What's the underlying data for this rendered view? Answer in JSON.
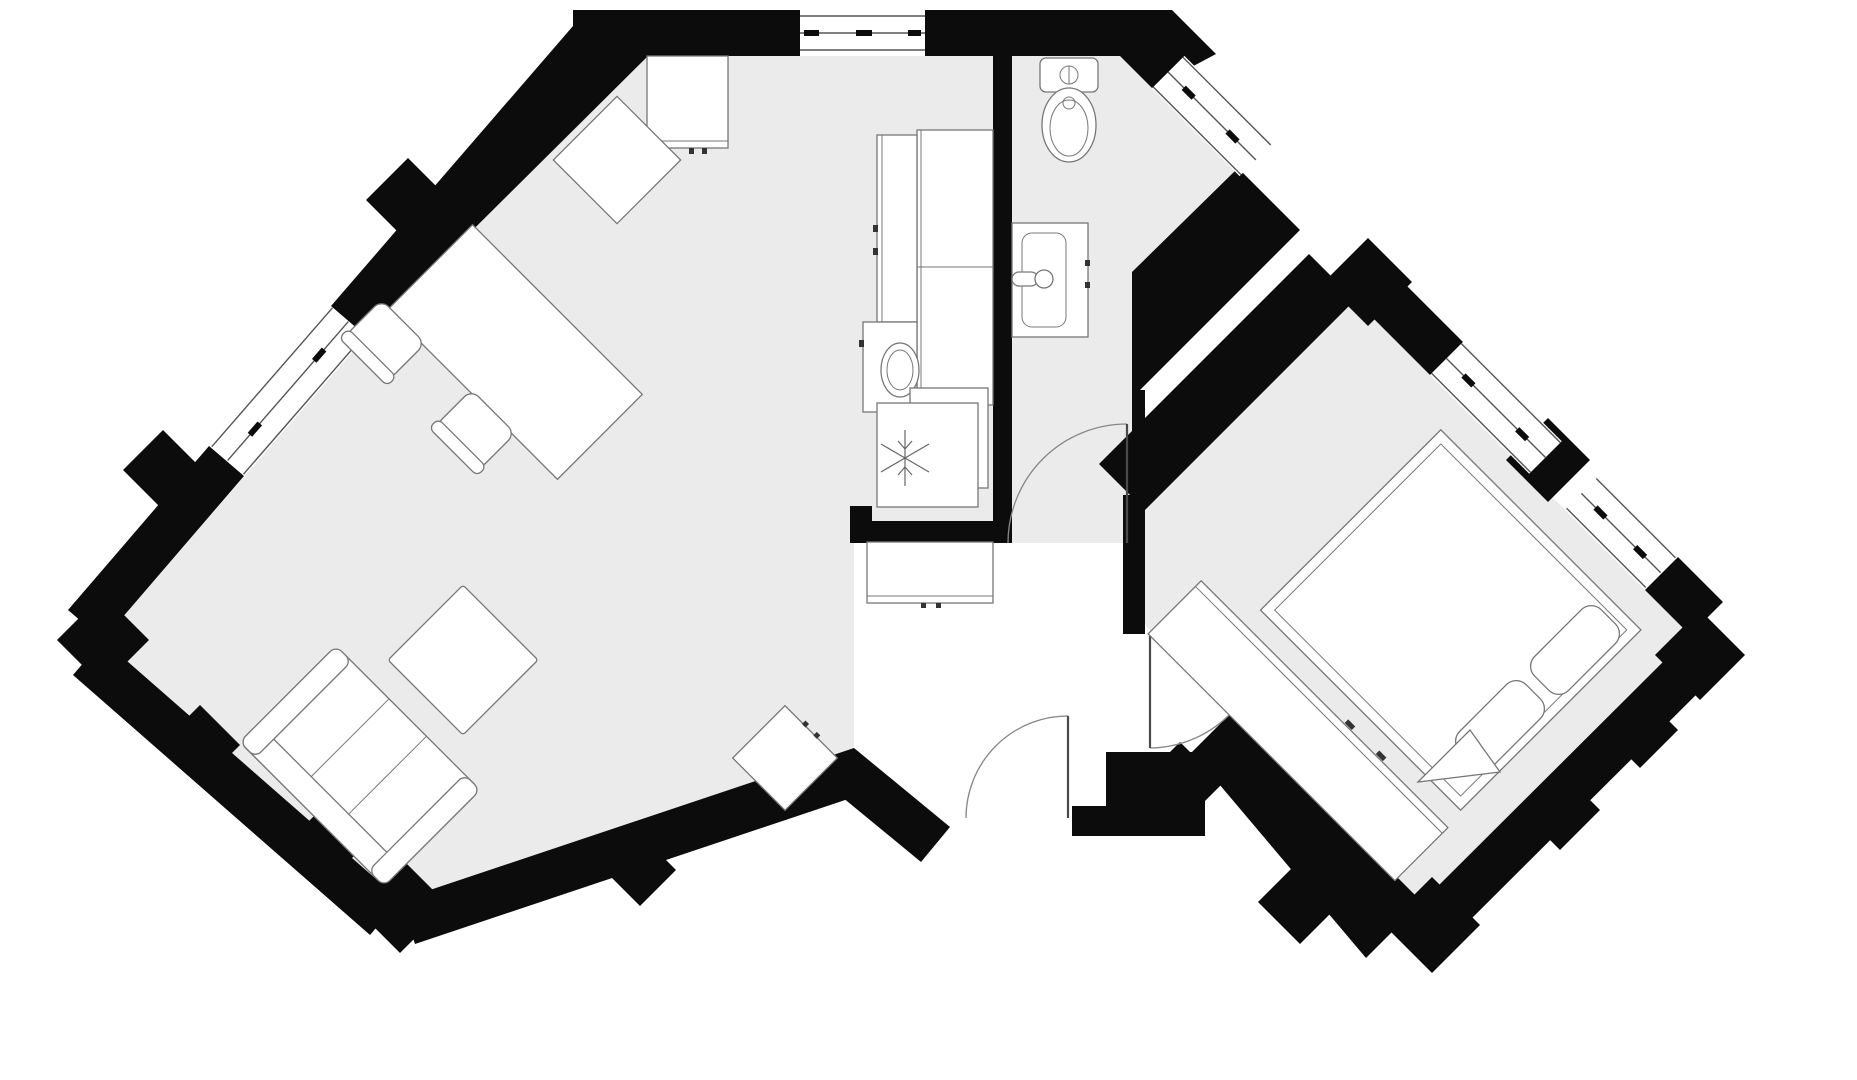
{
  "document": {
    "kind": "architectural floor plan",
    "description": "Black-and-white one-bedroom apartment floor plan with two 45-degree rotated wings, gray room floors, thick black stepped exterior walls, no text labels"
  },
  "colors": {
    "floor": "#ebebeb",
    "hall": "#ffffff",
    "wall": "#0c0c0c",
    "furnfill": "#ffffff",
    "furnline": "#777777",
    "glassline": "#555555",
    "door": "#888888"
  },
  "rooms": [
    {
      "id": "living-room",
      "label": "living room (rotated wing, open plan)",
      "furniture": [
        "wall cabinet",
        "desk",
        "dining table",
        "chair",
        "chair",
        "three-seat sofa",
        "coffee table",
        "side table"
      ]
    },
    {
      "id": "kitchen",
      "label": "kitchen strip (open to living room)",
      "furniture": [
        "tall cabinet column",
        "counter with sink",
        "base unit",
        "refrigerator with snowflake symbol"
      ]
    },
    {
      "id": "bathroom",
      "label": "bathroom (top center-right)",
      "furniture": [
        "toilet",
        "washbasin vanity"
      ]
    },
    {
      "id": "hallway",
      "label": "entrance hallway (white floor)",
      "furniture": [
        "wardrobe / shoe cabinet"
      ]
    },
    {
      "id": "bedroom",
      "label": "bedroom (rotated wing, right)",
      "furniture": [
        "double bed",
        "pillow",
        "pillow",
        "folded blanket corner",
        "long wardrobe"
      ]
    }
  ],
  "doors": [
    {
      "id": "door-bathroom",
      "connects": "hallway to bathroom",
      "swing": "into bathroom"
    },
    {
      "id": "door-bedroom",
      "connects": "hallway to bedroom",
      "swing": "into bedroom"
    },
    {
      "id": "door-entry",
      "connects": "outside to hallway",
      "swing": "into hallway"
    }
  ],
  "windows": [
    {
      "id": "window-nw",
      "wall": "living room north-west diagonal wall"
    },
    {
      "id": "window-top",
      "wall": "kitchen top wall"
    },
    {
      "id": "window-bathroom",
      "wall": "bathroom north-east diagonal wall"
    },
    {
      "id": "window-bedroom-1",
      "wall": "bedroom north-east diagonal wall"
    },
    {
      "id": "window-bedroom-2",
      "wall": "bedroom north-east diagonal wall"
    }
  ],
  "counts": {
    "rooms": 5,
    "doors": 3,
    "windows": 5
  }
}
